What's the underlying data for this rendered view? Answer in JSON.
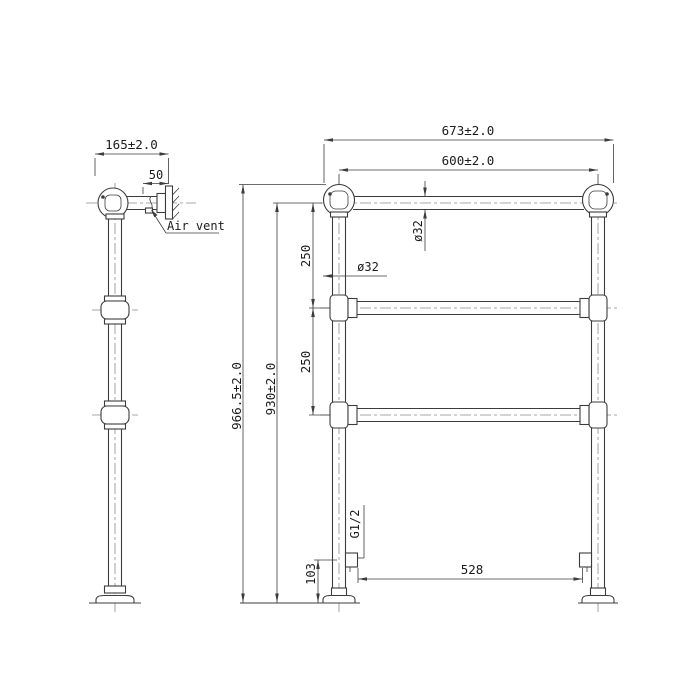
{
  "canvas": {
    "background": "#ffffff",
    "line_color": "#3c3c3c",
    "centerline_color": "#8a8a8a",
    "text_color": "#1c1c1c"
  },
  "side_view": {
    "wall_distance_dim": "165±2.0",
    "bracket_depth_dim": "50",
    "air_vent_label": "Air vent"
  },
  "front_view": {
    "overall_width_dim": "673±2.0",
    "post_centers_dim": "600±2.0",
    "overall_height_dim": "966.5±2.0",
    "top_rail_height_dim": "930±2.0",
    "upper_rail_gap_dim": "250",
    "lower_rail_gap_dim": "250",
    "rail_diameter_dim": "ø32",
    "post_diameter_dim": "ø32",
    "valve_thread_label": "G1/2",
    "valve_height_dim": "103",
    "valve_centers_dim": "528"
  }
}
